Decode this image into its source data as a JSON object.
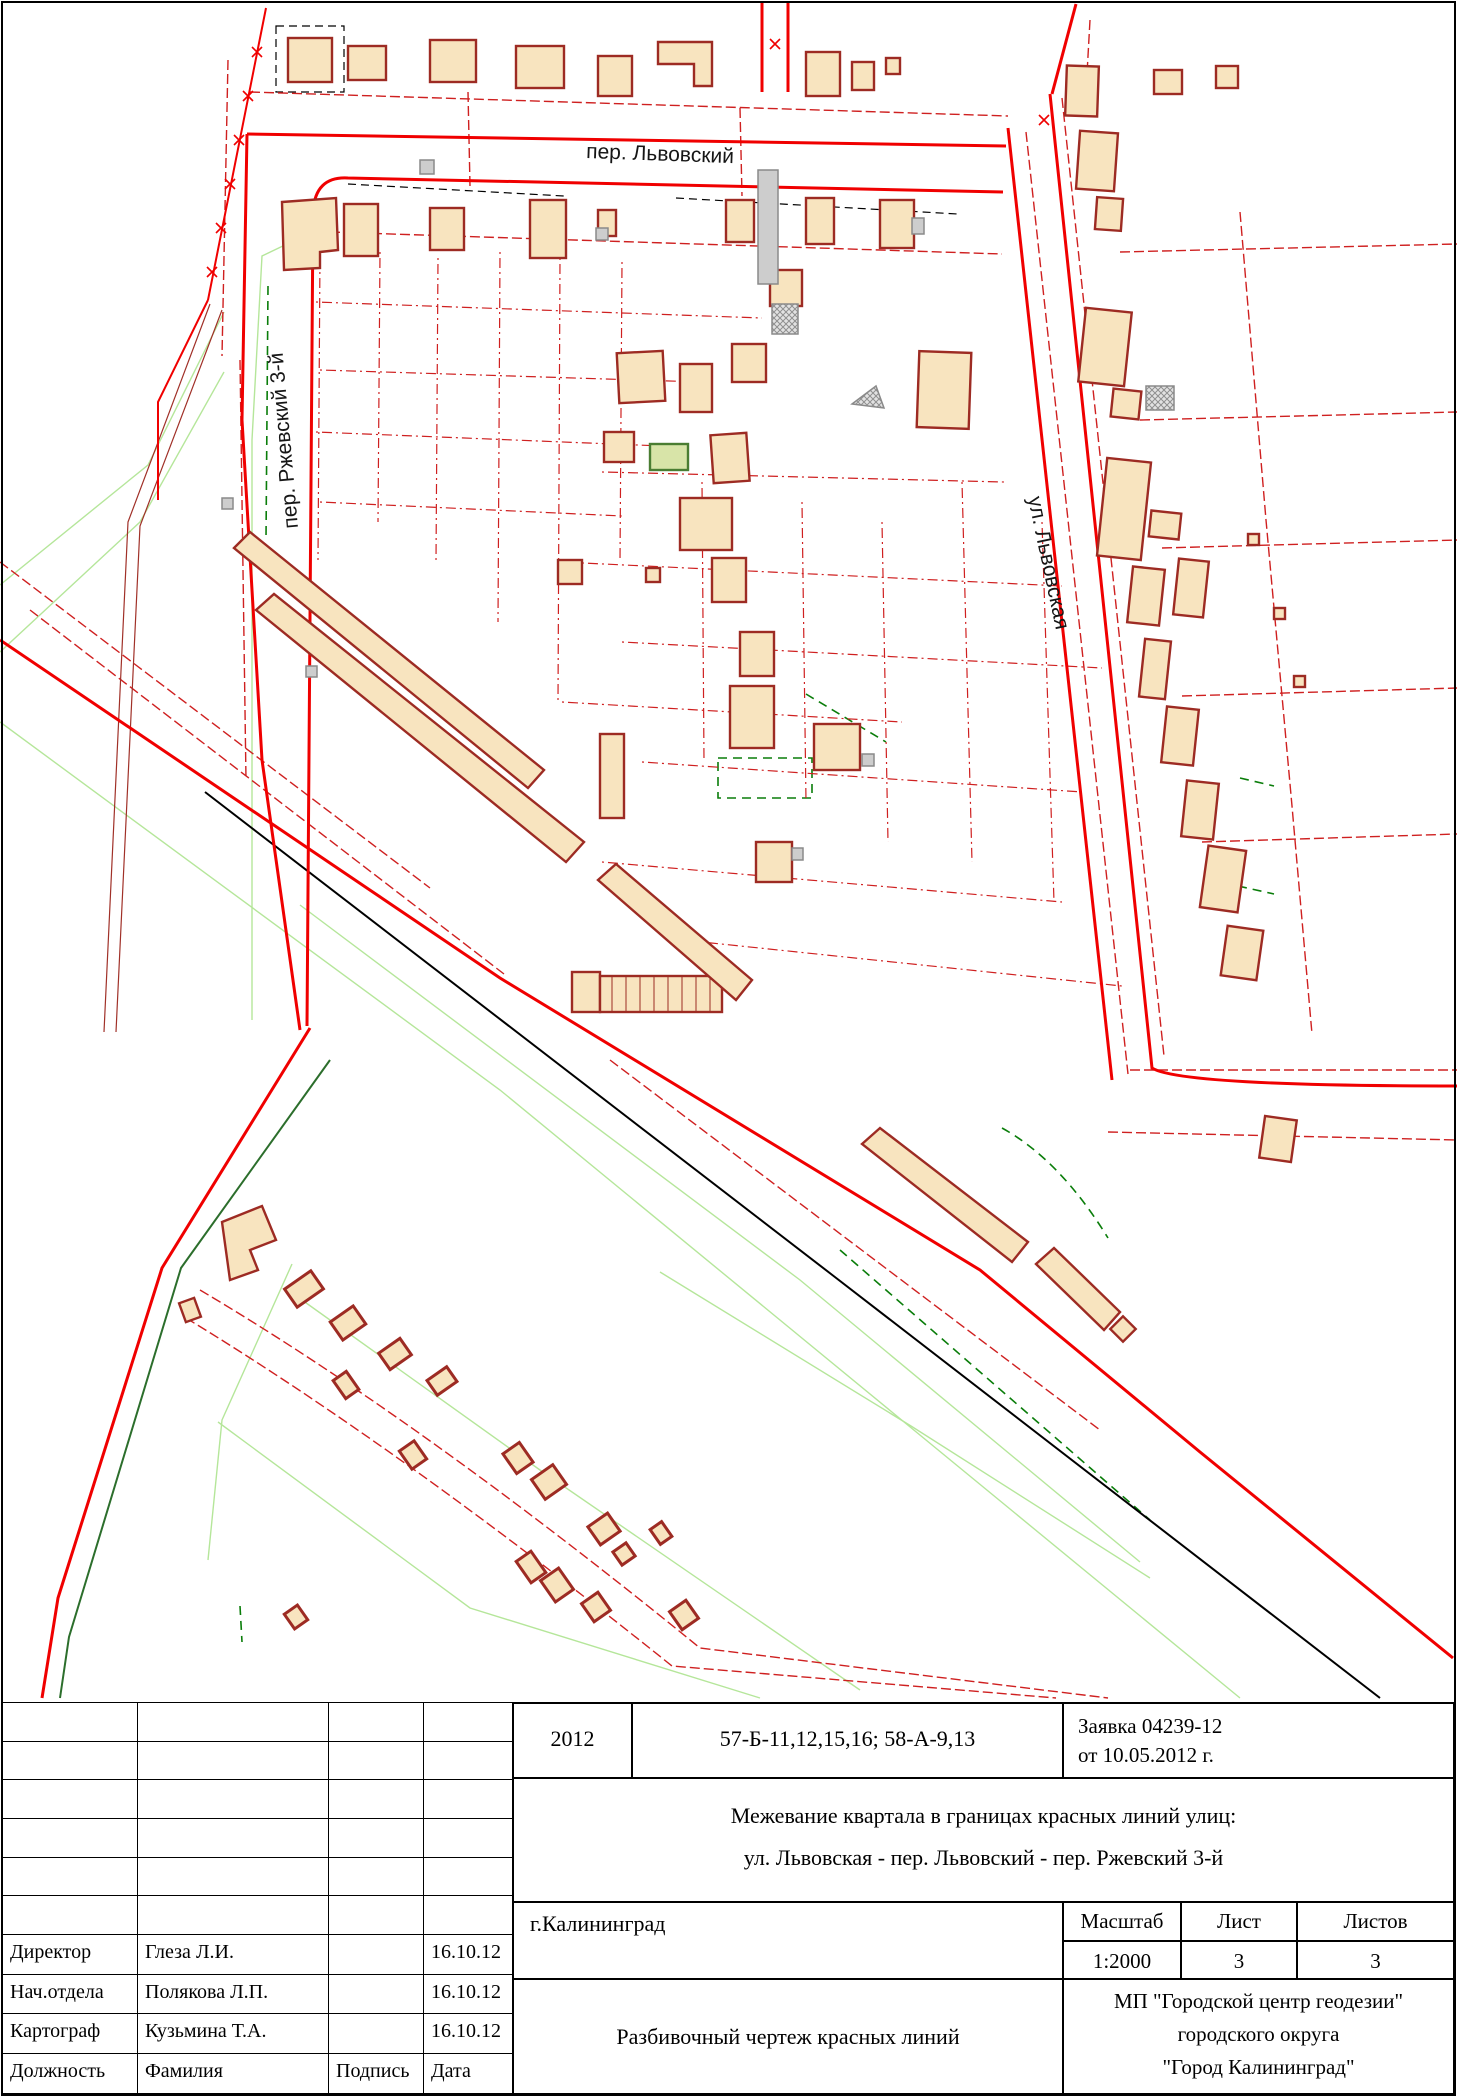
{
  "map": {
    "street_labels": {
      "top": "пер. Львовский",
      "left": "пер. Ржевский 3-й",
      "right": "ул. Львовская"
    },
    "colors": {
      "red_line": "#f00000",
      "dashed_red": "#cf2020",
      "building_fill": "#f8e4bf",
      "building_outline": "#9d2b23",
      "light_green": "#b5e69a",
      "dark_green": "#2c6e2c",
      "green_dashed": "#0a7d0a",
      "rail_black": "#000000"
    }
  },
  "title_block": {
    "year": "2012",
    "sheet_codes": "57-Б-11,12,15,16; 58-А-9,13",
    "request_line1": "Заявка 04239-12",
    "request_line2": "от 10.05.2012 г.",
    "subject_line1": "Межевание квартала в границах красных линий улиц:",
    "subject_line2": "ул. Львовская - пер. Львовский - пер. Ржевский 3-й",
    "city": "г.Калининград",
    "scale_label": "Масштаб",
    "scale_value": "1:2000",
    "sheet_label": "Лист",
    "sheet_value": "3",
    "sheets_label": "Листов",
    "sheets_value": "3",
    "doc_type": "Разбивочный чертеж красных линий",
    "org_line1": "МП \"Городской центр геодезии\"",
    "org_line2": "городского округа",
    "org_line3": "\"Город Калининград\"",
    "signatures": {
      "rows": [
        {
          "role": "Директор",
          "name": "Глеза Л.И.",
          "signature": "",
          "date": "16.10.12"
        },
        {
          "role": "Нач.отдела",
          "name": "Полякова Л.П.",
          "signature": "",
          "date": "16.10.12"
        },
        {
          "role": "Картограф",
          "name": "Кузьмина Т.А.",
          "signature": "",
          "date": "16.10.12"
        },
        {
          "role": "Должность",
          "name": "Фамилия",
          "signature": "Подпись",
          "date": "Дата"
        }
      ]
    }
  }
}
